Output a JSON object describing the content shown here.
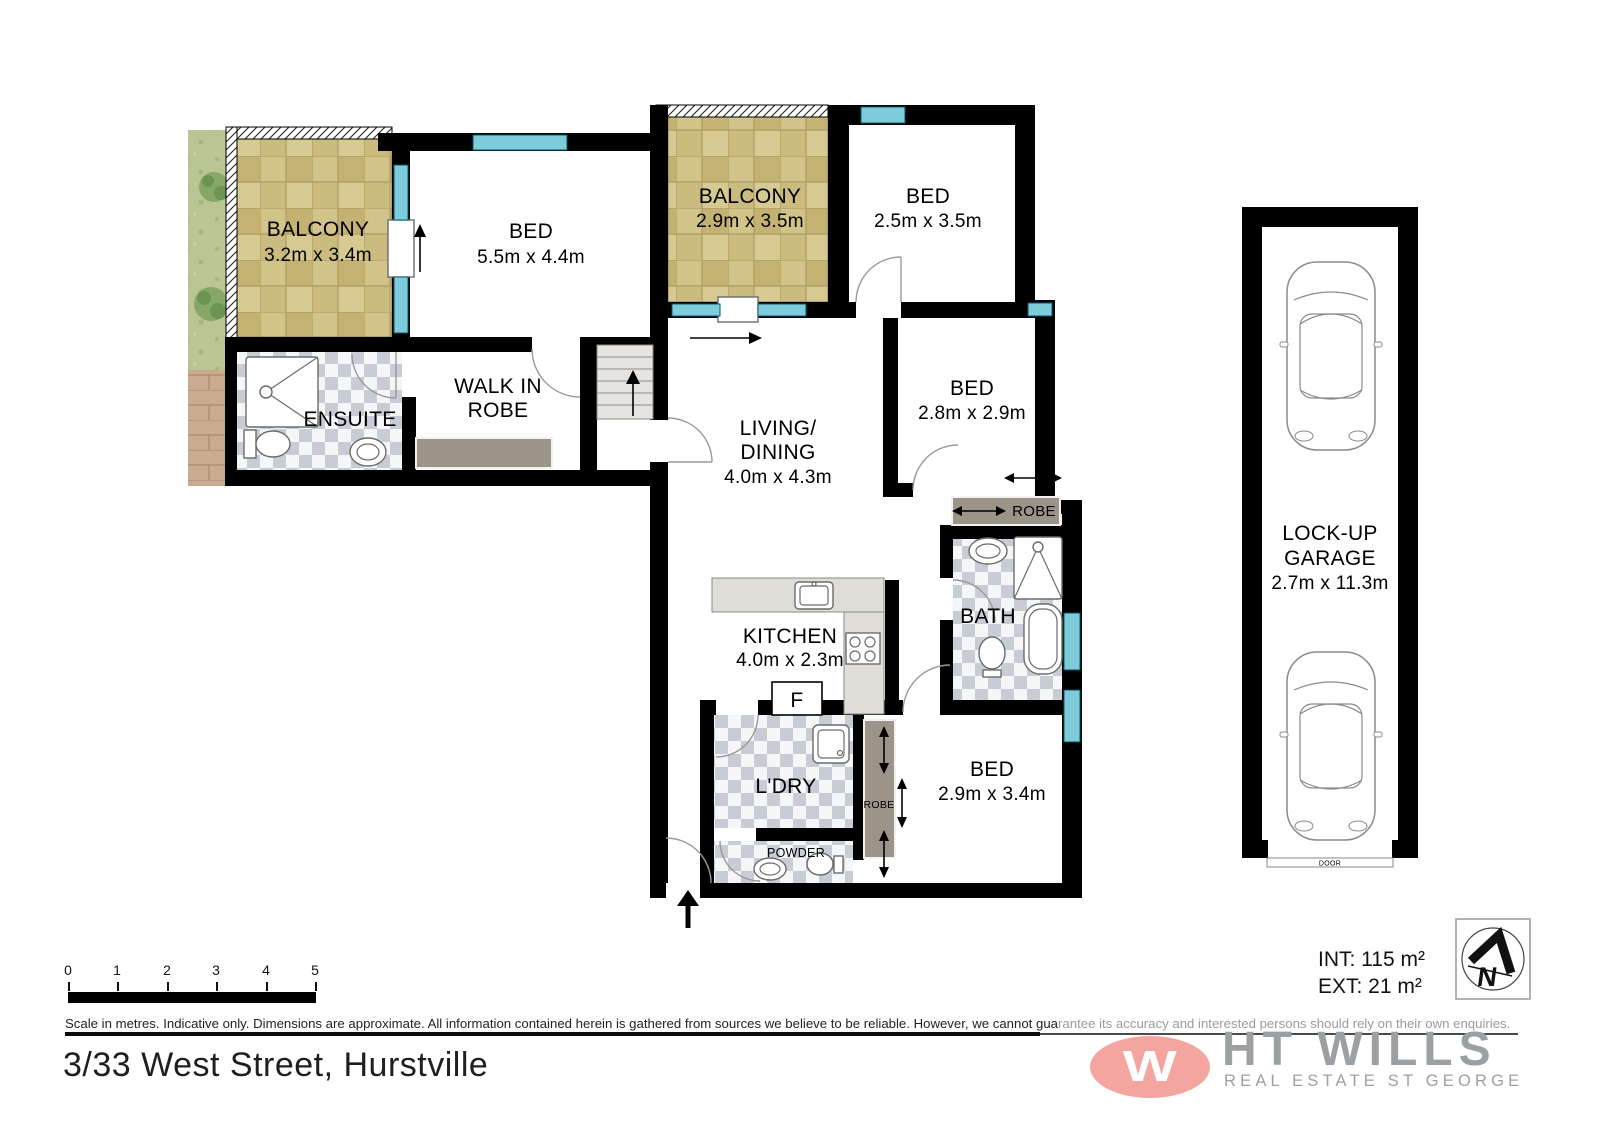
{
  "plan": {
    "rooms": {
      "balcony1": {
        "name": "BALCONY",
        "dims": "3.2m x 3.4m"
      },
      "bed1": {
        "name": "BED",
        "dims": "5.5m x 4.4m"
      },
      "balcony2": {
        "name": "BALCONY",
        "dims": "2.9m x 3.5m"
      },
      "bed2": {
        "name": "BED",
        "dims": "2.5m x 3.5m"
      },
      "living": {
        "name1": "LIVING/",
        "name2": "DINING",
        "dims": "4.0m x 4.3m"
      },
      "bed3": {
        "name": "BED",
        "dims": "2.8m x 2.9m"
      },
      "walkinrobe": {
        "name1": "WALK IN",
        "name2": "ROBE"
      },
      "ensuite": {
        "name": "ENSUITE"
      },
      "kitchen": {
        "name": "KITCHEN",
        "dims": "4.0m x 2.3m"
      },
      "fridge": {
        "name": "F"
      },
      "bath": {
        "name": "BATH"
      },
      "robe3": {
        "name": "ROBE"
      },
      "laundry": {
        "name": "L'DRY"
      },
      "powder": {
        "name": "POWDER"
      },
      "robe4": {
        "name": "ROBE"
      },
      "bed4": {
        "name": "BED",
        "dims": "2.9m x 3.4m"
      },
      "garage": {
        "name1": "LOCK-UP",
        "name2": "GARAGE",
        "dims": "2.7m x 11.3m"
      },
      "garage_door": {
        "name": "DOOR"
      }
    }
  },
  "scalebar": {
    "ticks": [
      "0",
      "1",
      "2",
      "3",
      "4",
      "5"
    ]
  },
  "disclaimer": {
    "part1": "Scale in metres. Indicative only. Dimensions are approximate. All information contained herein is gathered from sources we believe to be reliable. However, we cannot gua",
    "part2": "rantee its accuracy and interested persons should rely on their own enquiries."
  },
  "address": "3/33 West Street, Hurstville",
  "areas": {
    "internal": "INT: 115 m²",
    "external": "EXT: 21 m²"
  },
  "logo": {
    "monogram": "W",
    "brand": "HT WILLS",
    "tagline": "REAL ESTATE ST GEORGE"
  },
  "compass": {
    "label": "N"
  },
  "colors": {
    "wall": "#000000",
    "window": "#7ecbdb",
    "tile": "#cdbd82",
    "checker": "#c7ccd5",
    "joinery": "#9c9389",
    "logo_pink": "#f4a5a0",
    "logo_grey": "#9da0a3"
  }
}
